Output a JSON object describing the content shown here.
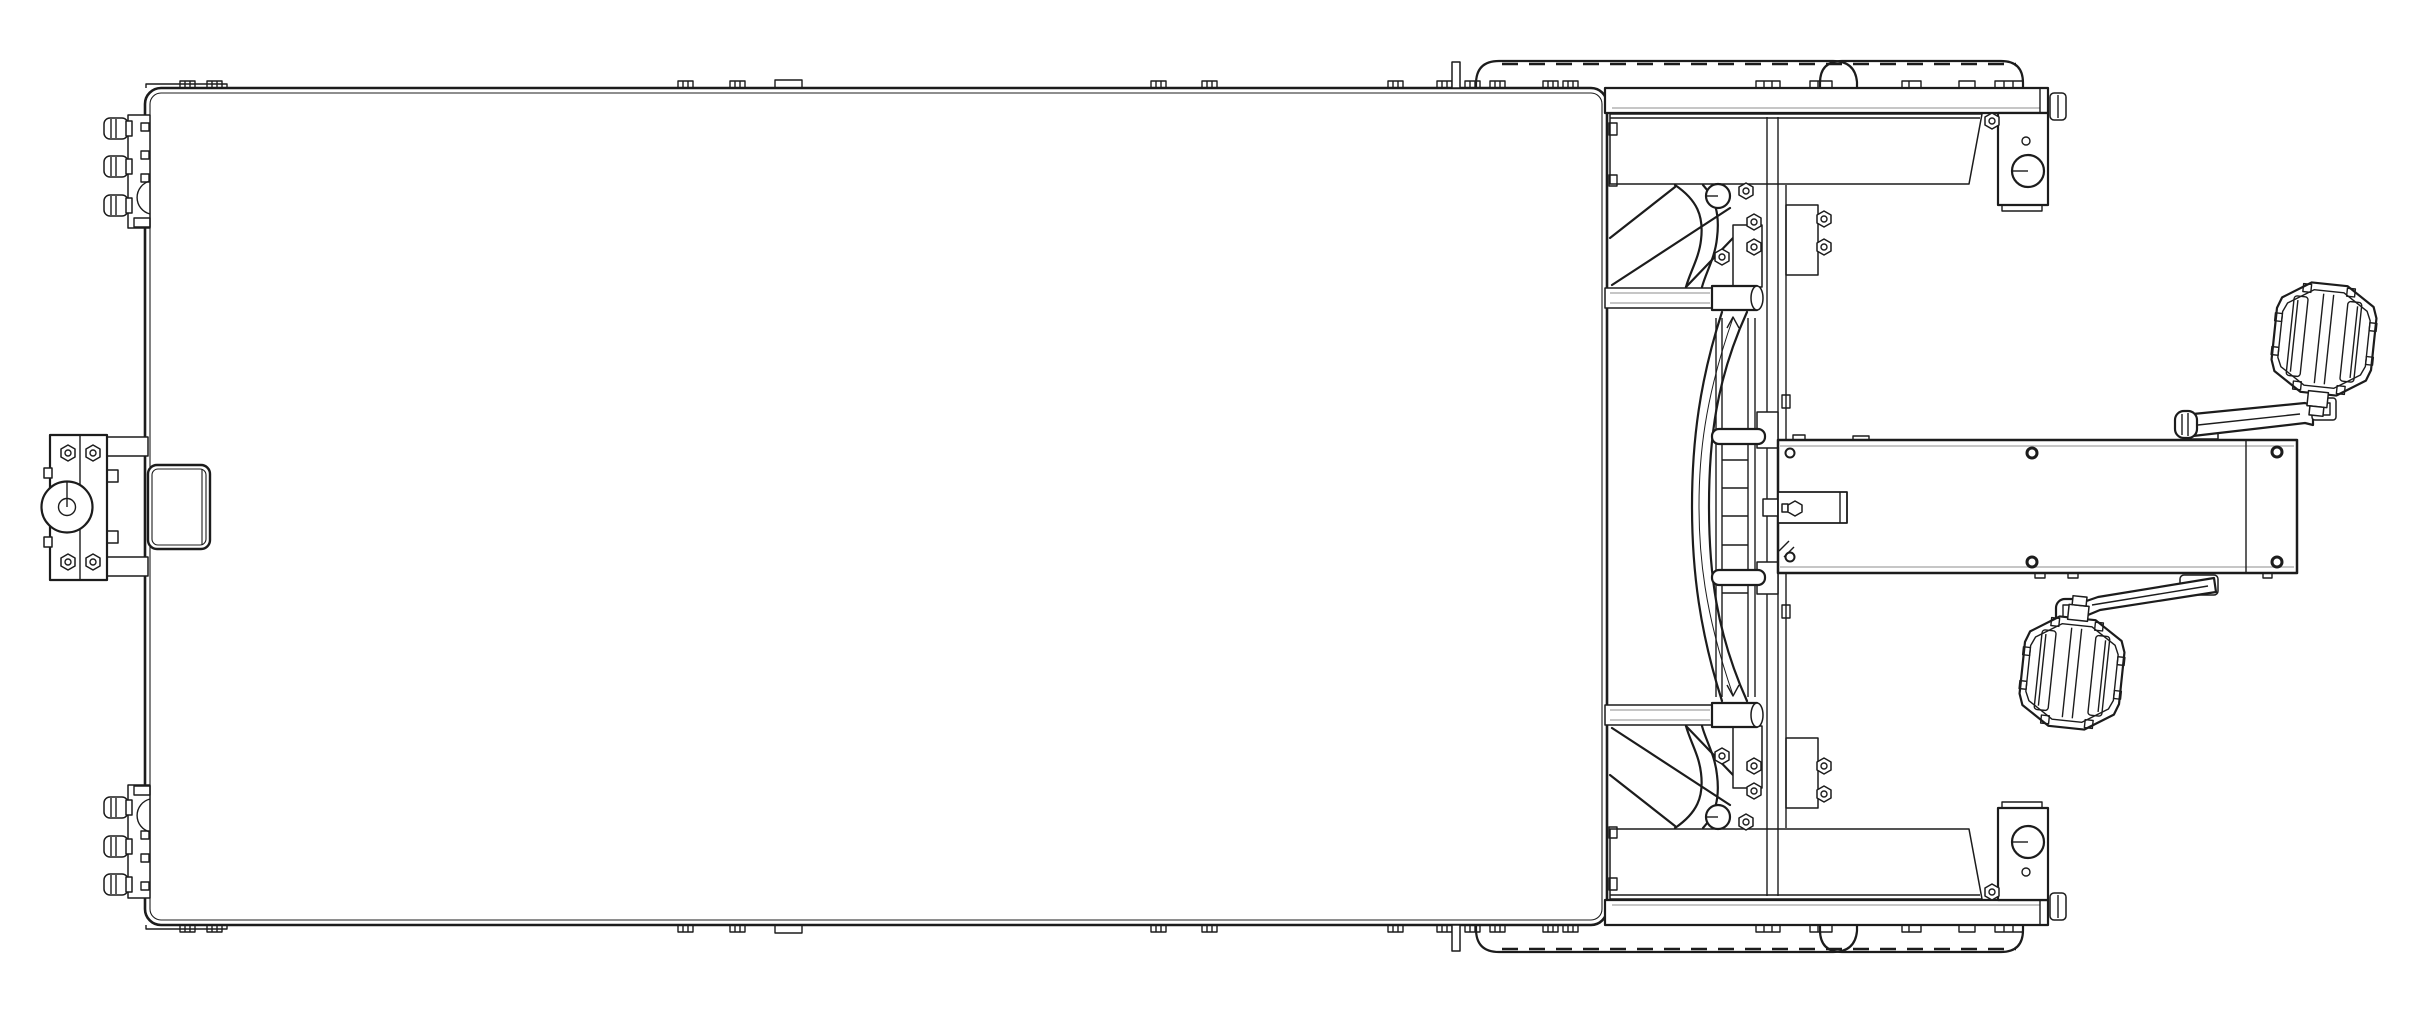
{
  "title": "Technical line drawing — pedal-drive flatbed trailer, top view",
  "canvas": {
    "width": "2409",
    "height": "1020",
    "background": "#ffffff",
    "line": "#1c1c1c",
    "thin": "#a5a5a5"
  },
  "parts": {
    "deck": "Flatbed deck",
    "deck_clips": "Deck edge clips",
    "hitch": "Front hitch coupler plate",
    "receiver_tube": "Hitch receiver tube",
    "side_mount_top": "Side mount bolts (top edge)",
    "side_mount_bottom": "Side mount bolts (bottom edge)",
    "wheel_top": "Wheel tires (top side)",
    "wheel_bottom": "Wheel tires (bottom side)",
    "rail_top": "Side rail and fender (top)",
    "rail_bottom": "Side rail and fender (bottom)",
    "axle_bracket_top": "Axle bracket with hub (top)",
    "axle_bracket_bottom": "Axle bracket with hub (bottom)",
    "frame_top": "Frame tubes and gusset plates (top)",
    "frame_bottom": "Frame tubes and gusset plates (bottom)",
    "mast": "Center mast, clamps and rack",
    "boom": "Bottom-bracket boom",
    "tongue": "Boom tongue with pinch bolt",
    "crank_top": "Crank arm (top)",
    "crank_bottom": "Crank arm (bottom)",
    "pedal_top": "Platform pedal (top)",
    "pedal_bottom": "Platform pedal (bottom)"
  }
}
